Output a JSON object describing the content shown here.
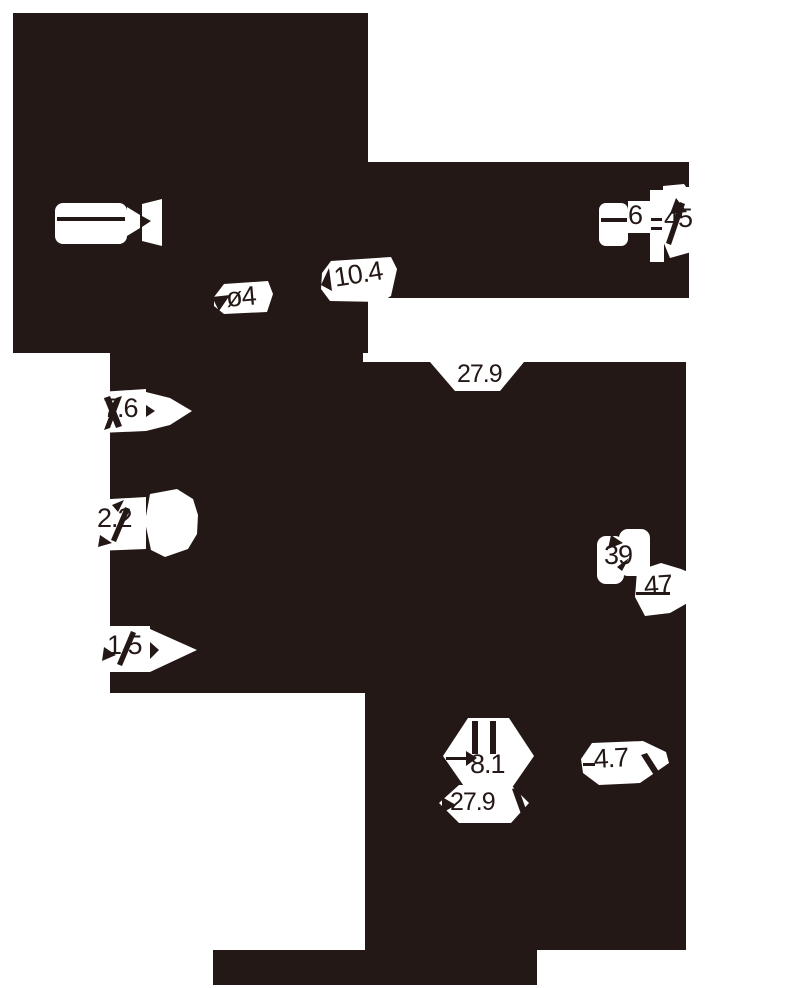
{
  "colors": {
    "ink": "#231815",
    "paper": "#ffffff"
  },
  "drawing": {
    "dimensions": {
      "diameter": "ø4",
      "len_10_4": "10.4",
      "len_6": "6",
      "angle_45": "45",
      "top_width_27_9": "27.9",
      "len_7_6": "7.6",
      "len_2_2": "2.2",
      "len_1_5": "1.5",
      "len_39": "39",
      "len_47": "47",
      "len_8_1": "8.1",
      "bottom_width_27_9": "27.9",
      "len_4_7": "4.7"
    }
  }
}
